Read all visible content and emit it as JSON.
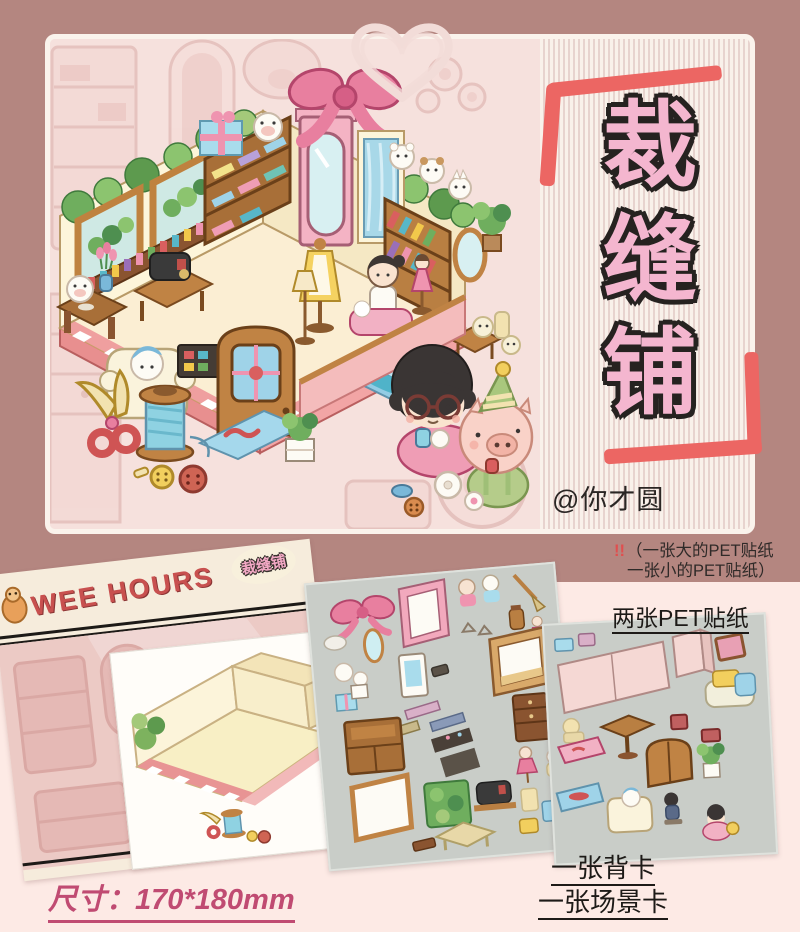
{
  "poster": {
    "heading": {
      "chars": [
        "裁",
        "缝",
        "铺"
      ]
    },
    "credit": "@你才圆",
    "note": {
      "bang": "!!",
      "line1": "（一张大的PET贴纸",
      "line2": "一张小的PET贴纸）"
    },
    "labels": {
      "pet_sheets": "两张PET贴纸",
      "back_card": "一张背卡",
      "scene_card": "一张场景卡",
      "size": "尺寸：170*180mm"
    },
    "back_card": {
      "brand": "WEE HOURS",
      "badge": "裁缝铺"
    },
    "colors": {
      "bg_top": "#b48680",
      "bg_bottom": "#fdeae5",
      "accent_red": "#ec6663",
      "title_pink": "#f4b6cf",
      "sheet_gray": "#c9cdc8",
      "size_text": "#c04b72",
      "brand_red": "#c8504f"
    },
    "icons": [
      "heart-scribble-icon",
      "corner-bracket-icon",
      "scissors-icon",
      "thread-spool-icon",
      "button-icon",
      "pink-bow-icon"
    ]
  }
}
